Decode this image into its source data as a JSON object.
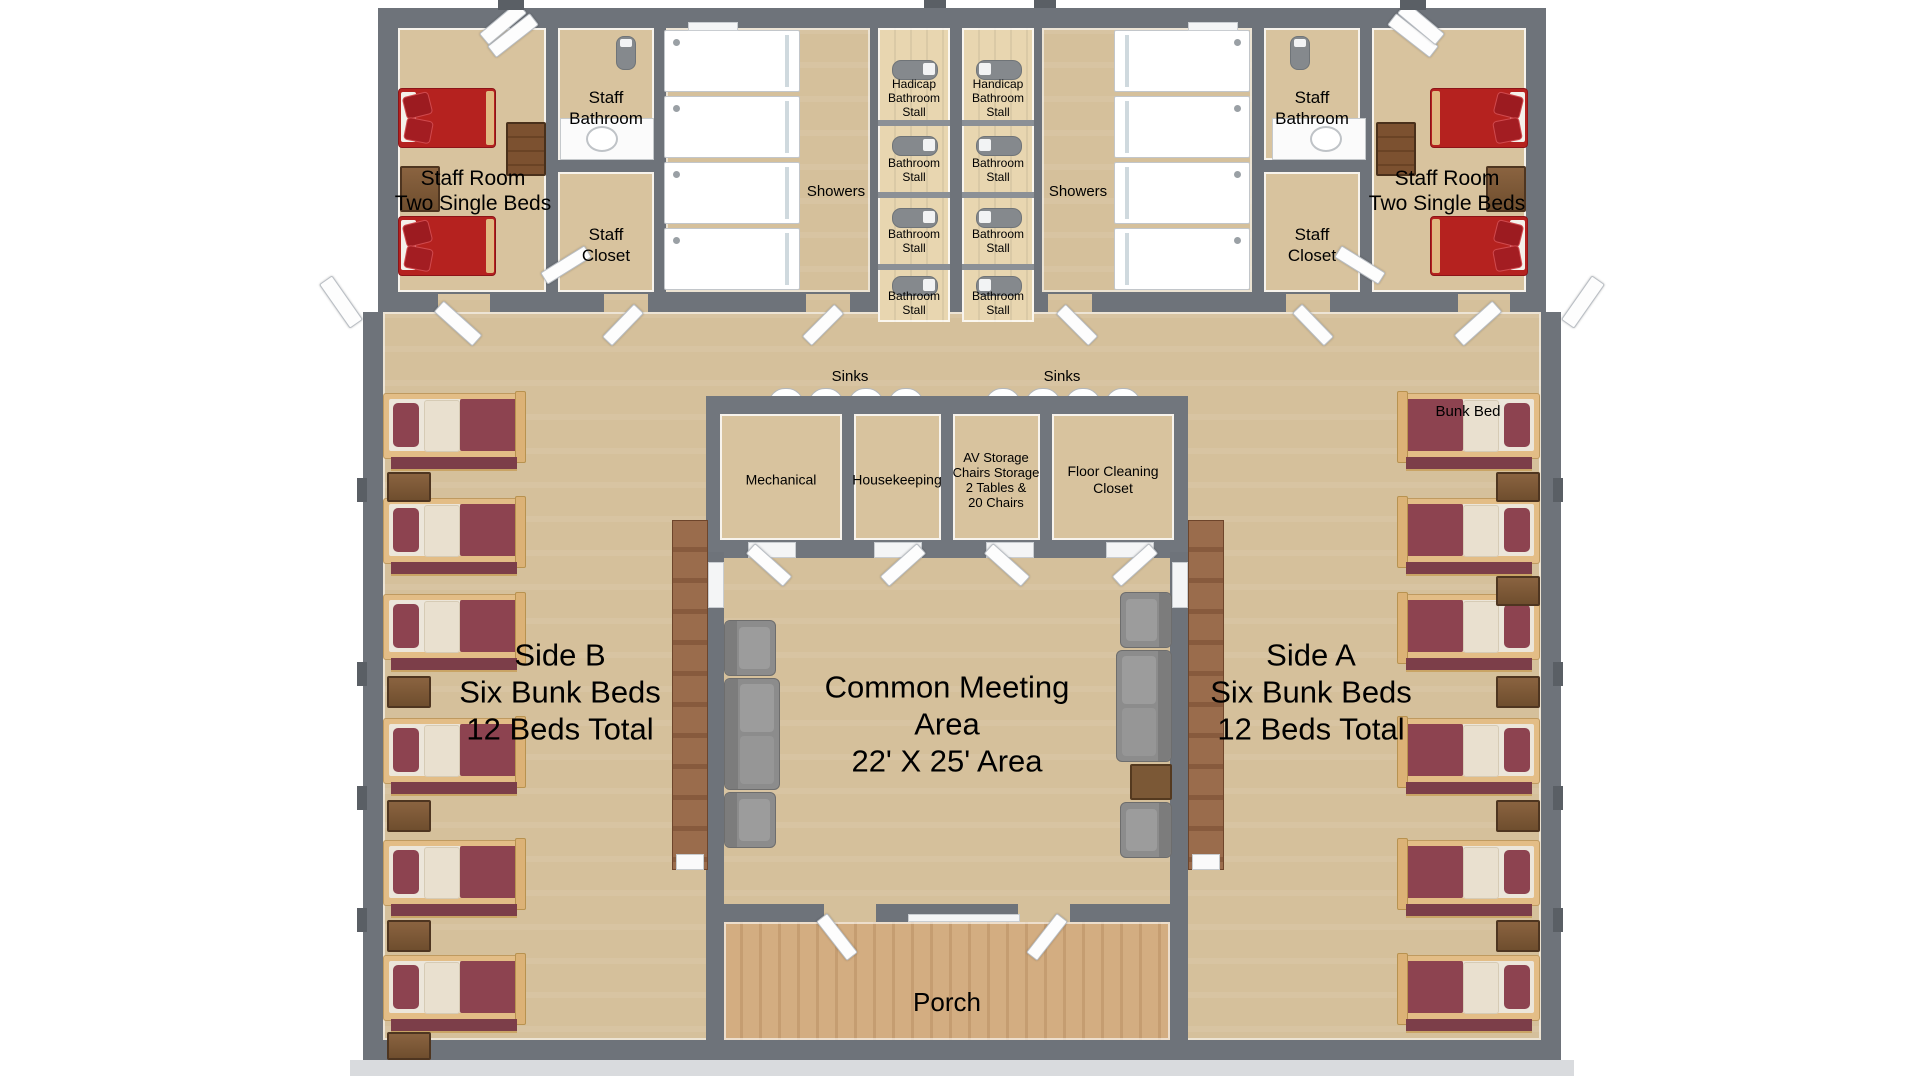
{
  "labels": {
    "staff_room": {
      "l1": "Staff Room",
      "l2": "Two Single Beds"
    },
    "staff_bathroom": {
      "l1": "Staff",
      "l2": "Bathroom"
    },
    "staff_closet": {
      "l1": "Staff",
      "l2": "Closet"
    },
    "showers": "Showers",
    "sinks": "Sinks",
    "stalls": {
      "handicap_left": "Hadicap Bathroom Stall",
      "handicap_right": "Handicap Bathroom Stall",
      "standard": "Bathroom Stall"
    },
    "storage": {
      "mechanical": "Mechanical",
      "housekeeping": "Housekeeping",
      "av1": "AV Storage",
      "av2": "Chairs Storage",
      "av3": "2 Tables &",
      "av4": "20 Chairs",
      "fc1": "Floor Cleaning",
      "fc2": "Closet"
    },
    "side_b": {
      "l1": "Side B",
      "l2": "Six Bunk Beds",
      "l3": "12 Beds Total"
    },
    "side_a": {
      "l1": "Side A",
      "l2": "Six Bunk Beds",
      "l3": "12 Beds Total"
    },
    "common": {
      "l1": "Common Meeting",
      "l2": "Area",
      "l3": "22' X 25' Area"
    },
    "porch": "Porch",
    "bunk_bed": "Bunk Bed"
  },
  "colors": {
    "wall": "#6e737a",
    "carpet": "#d5c09b",
    "stall_floor": "#e8d6b0",
    "porch_wood": "#d3ad81",
    "staff_bed_red": "#b5221f",
    "bunk_maroon": "#8d4350",
    "blanket_cream": "#e9e0cf",
    "bed_frame_wood": "#e3bd86",
    "counter_wood": "#9a6c4c",
    "sofa_gray": "#8c8c8c",
    "fixture_white": "#ffffff"
  }
}
